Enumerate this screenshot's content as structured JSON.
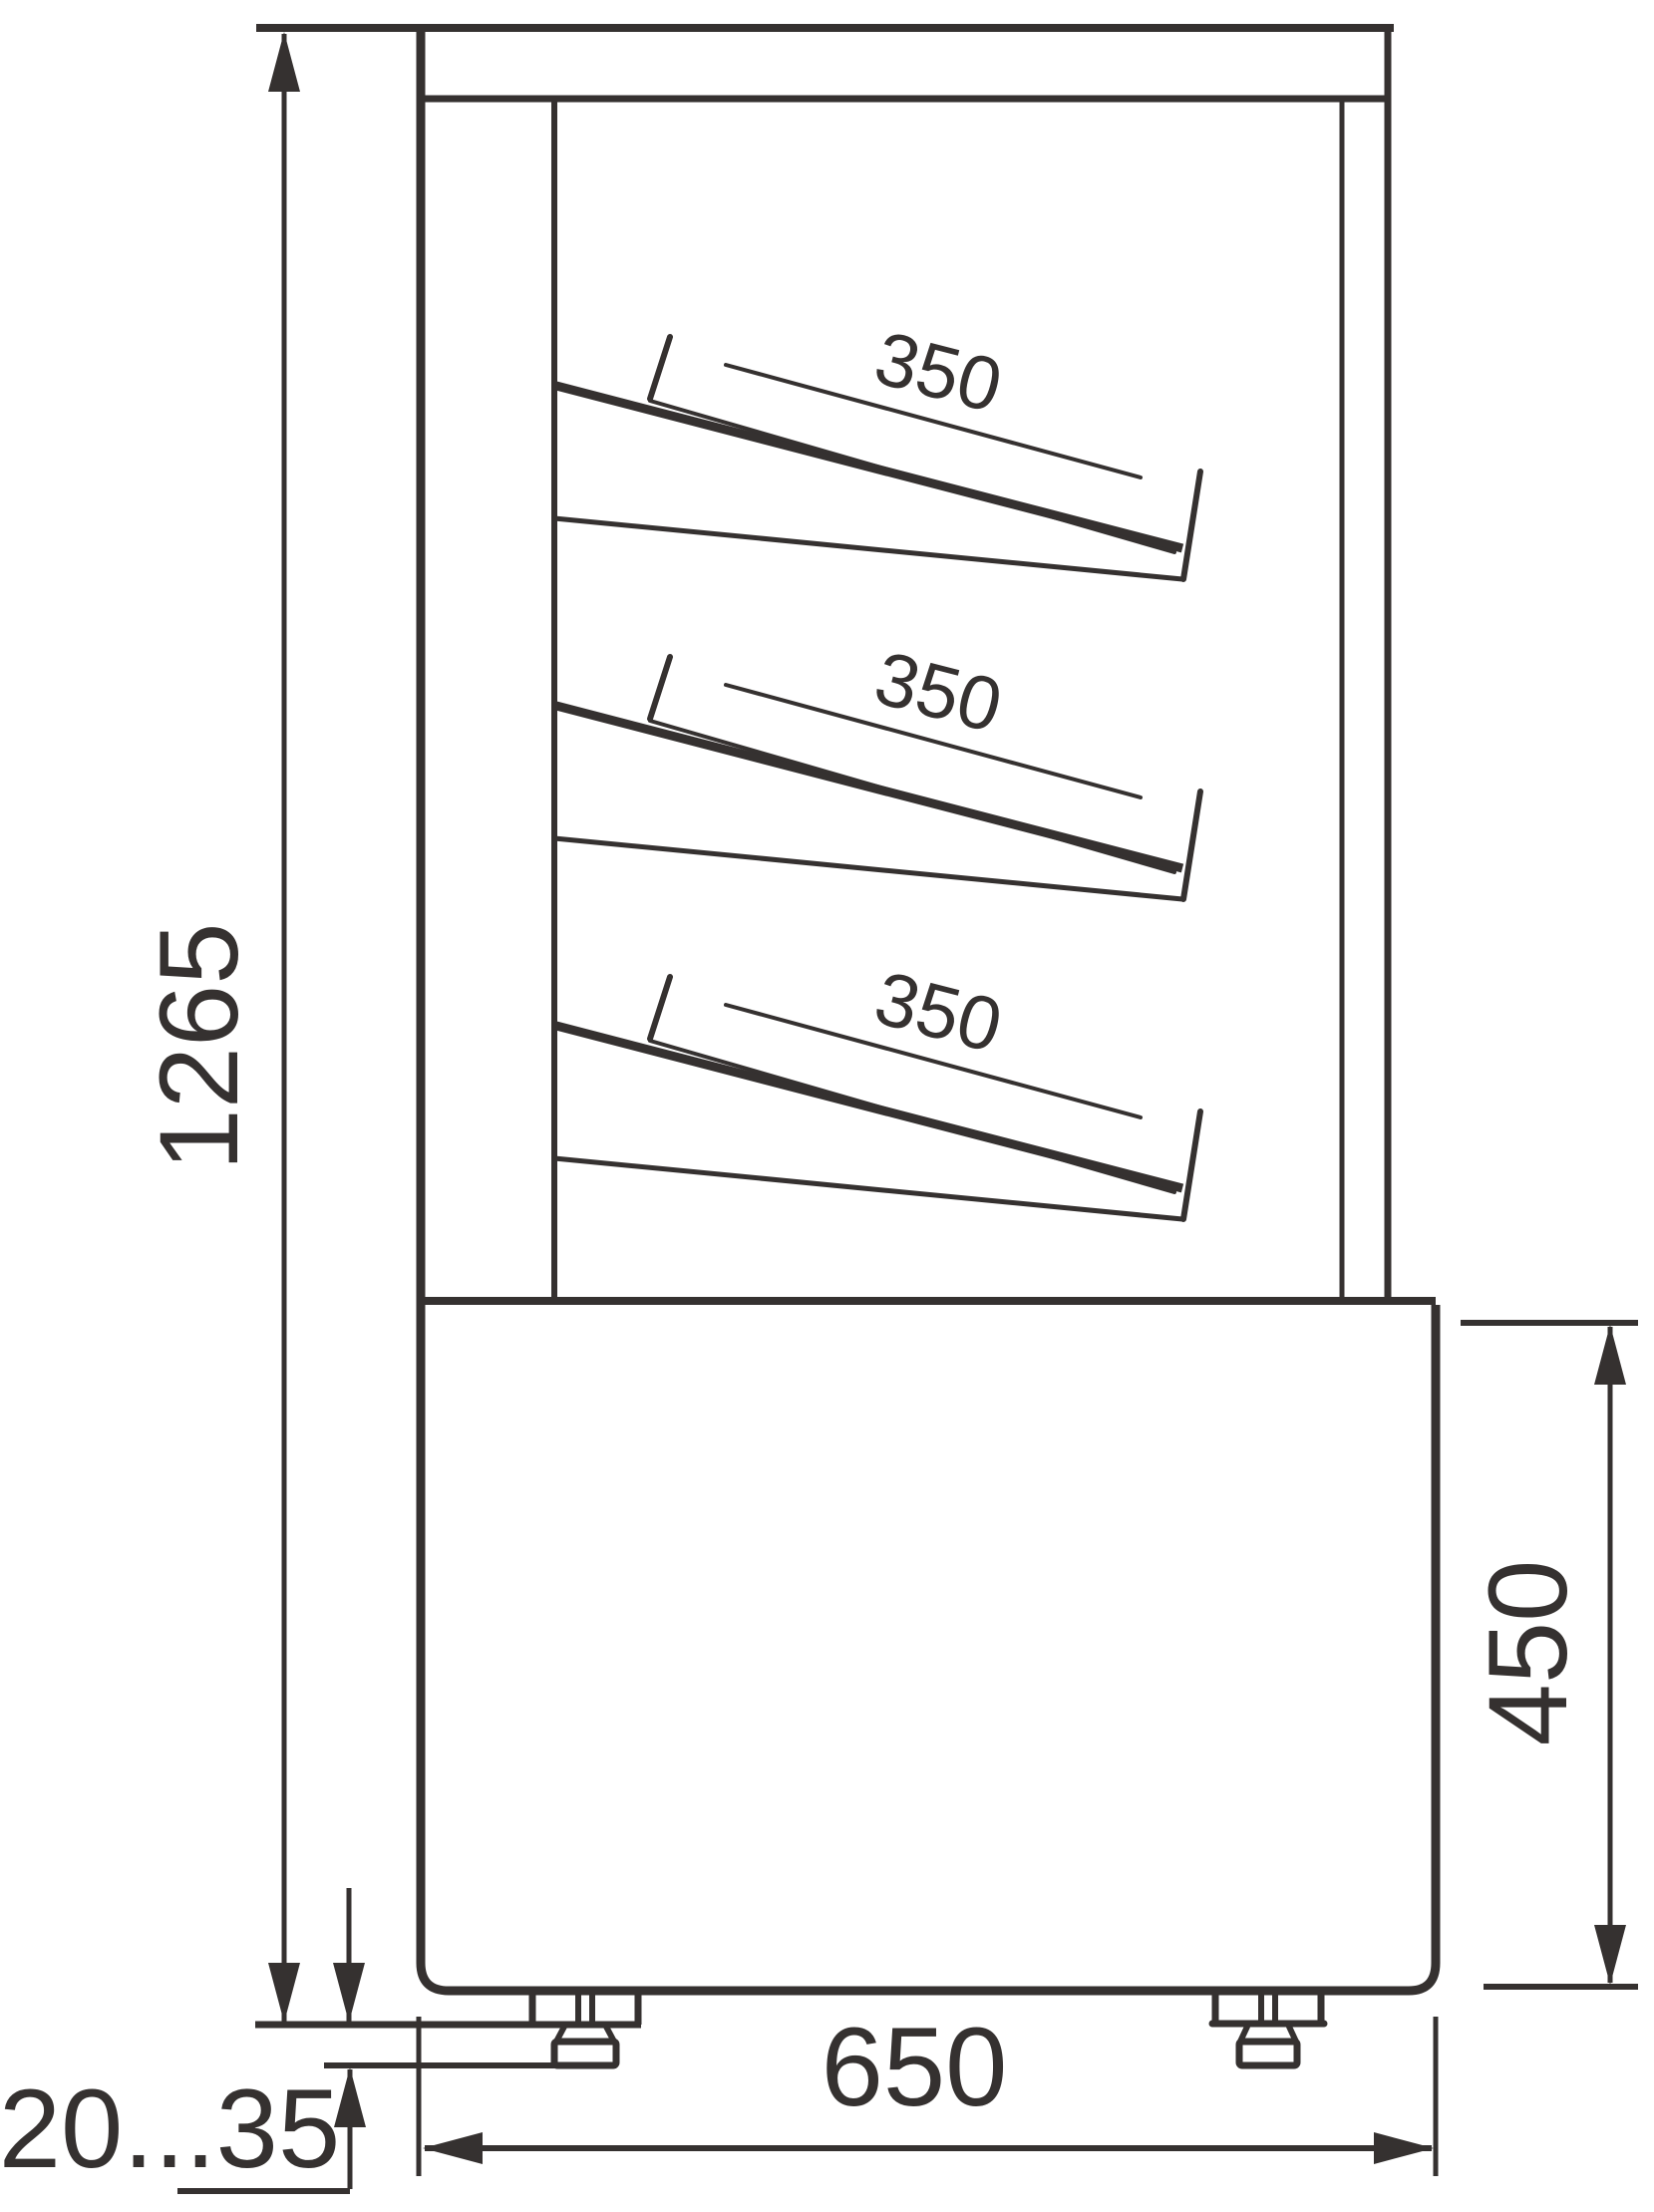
{
  "diagram": {
    "type": "technical-drawing",
    "colors": {
      "line": "#353130",
      "background": "#ffffff"
    },
    "dimensions": {
      "overall_height_label": "1265",
      "shelf_depth_labels": [
        "350",
        "350",
        "350"
      ],
      "base_height_label": "450",
      "base_depth_label": "650",
      "foot_adjustment_label": "20...35"
    }
  }
}
